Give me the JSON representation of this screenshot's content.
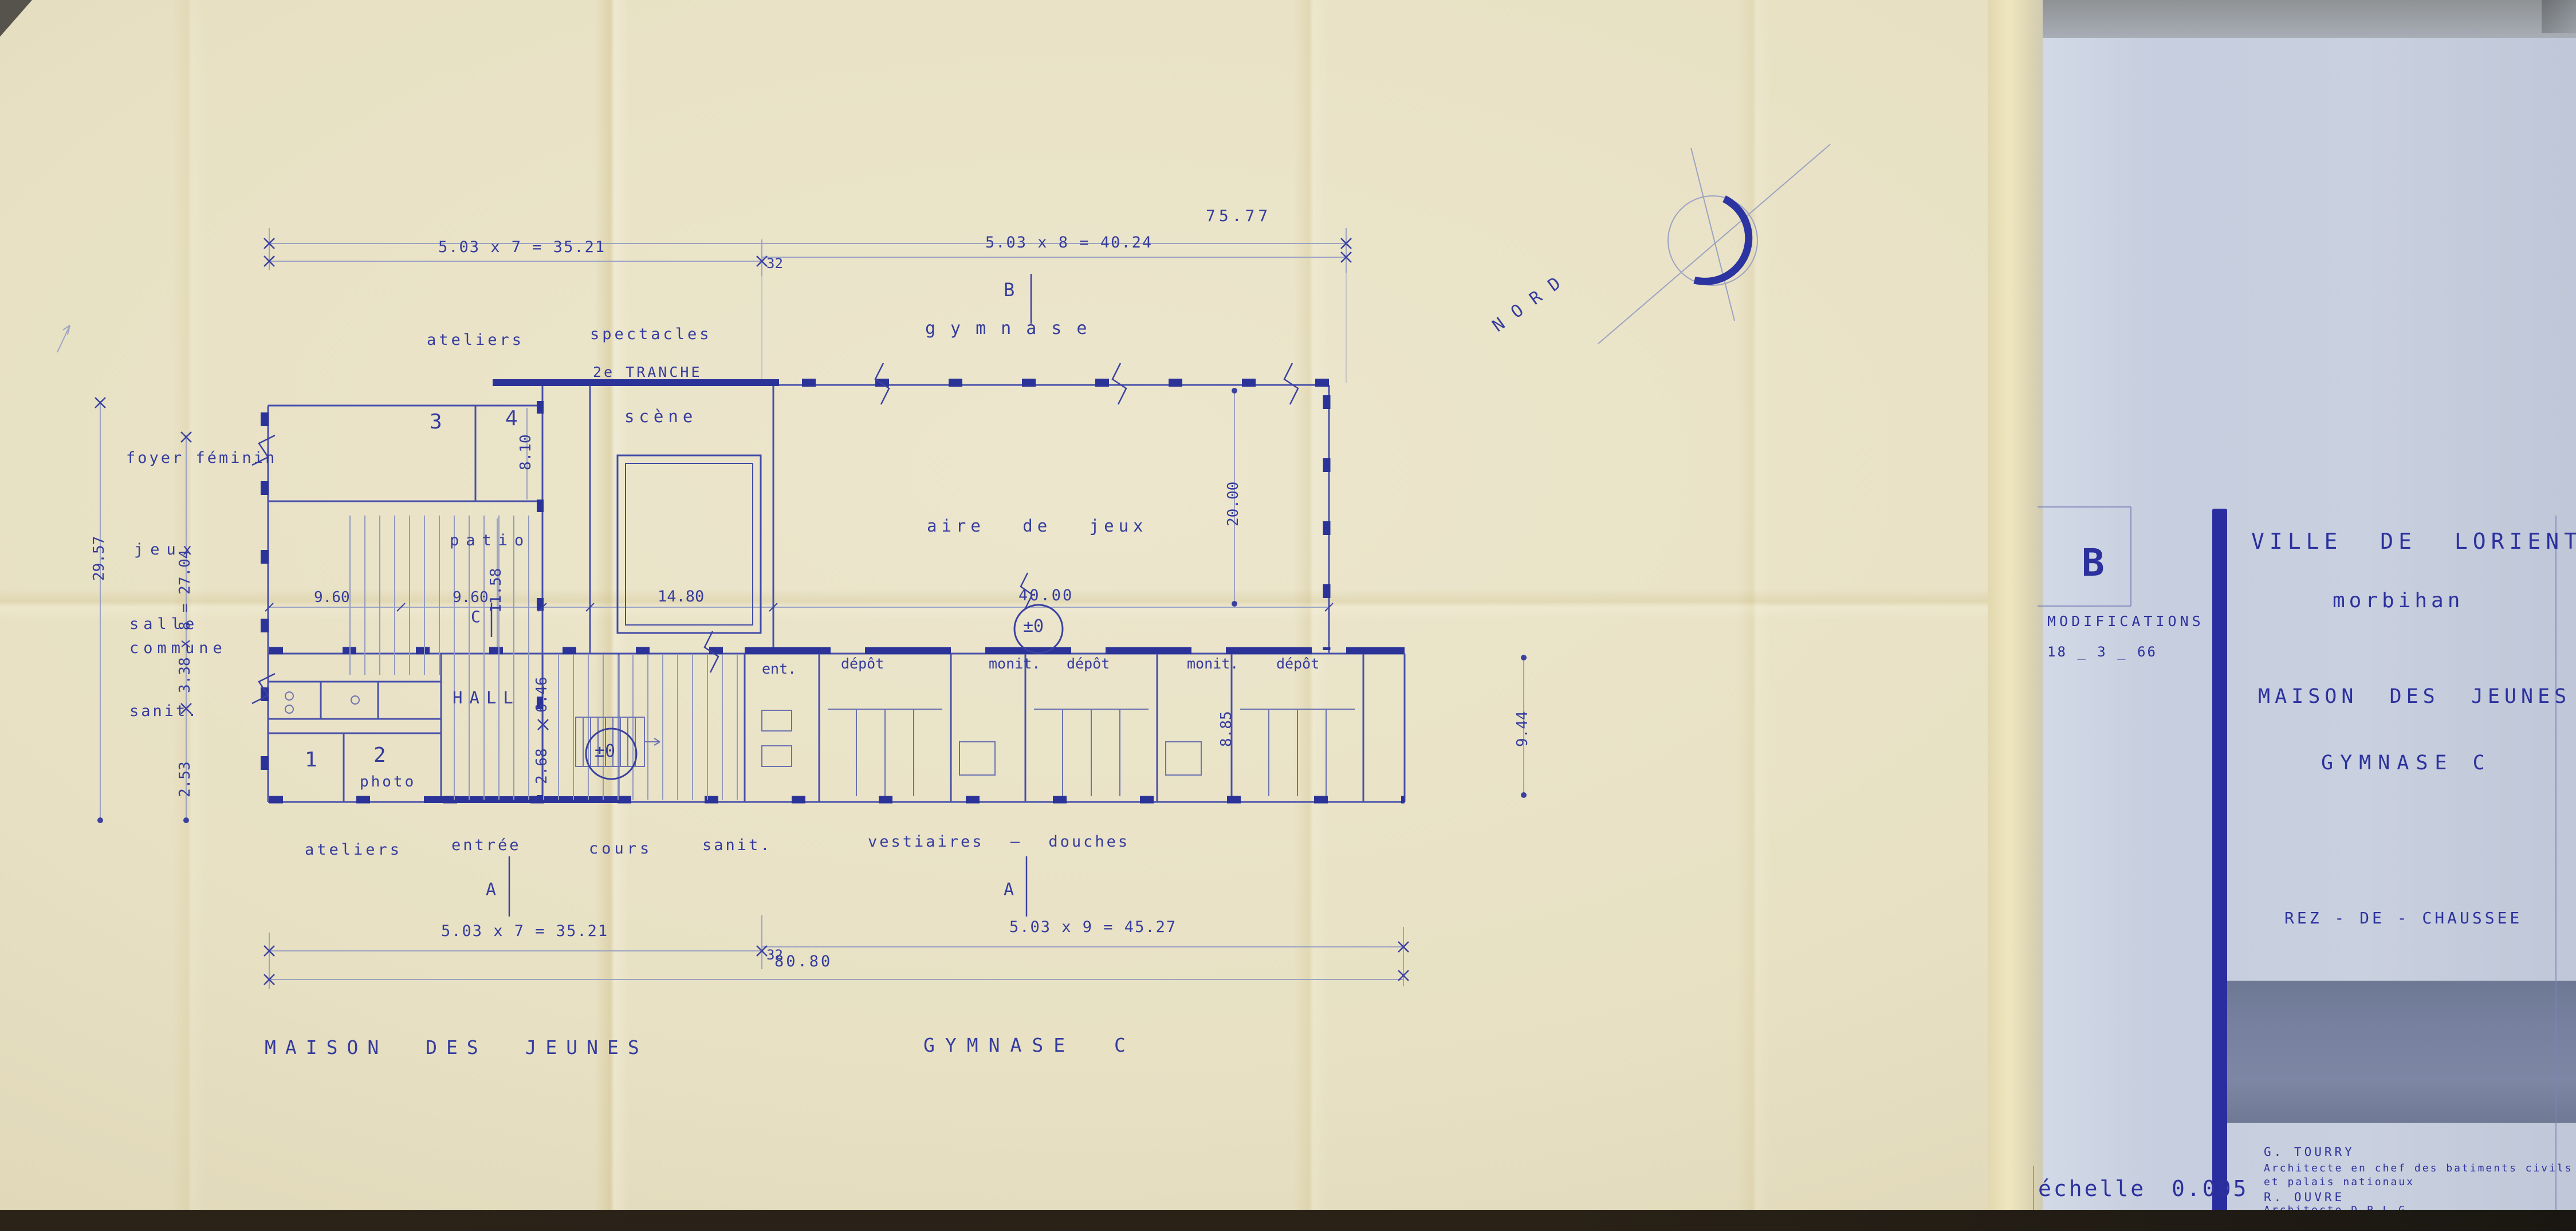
{
  "colors": {
    "paper": "#e8e1c4",
    "panel": "#c6cedf",
    "slate_band": "#77819f",
    "ink": "#353c9e",
    "ink_dark": "#2c319e",
    "pencil": "#9ca3c3",
    "edge": "#2b2318"
  },
  "title_block": {
    "revision_letter": "B",
    "modifications_label": "MODIFICATIONS",
    "modification_date": "18 _ 3 _ 66",
    "city": "VILLE DE LORIENT",
    "department": "morbihan",
    "project": "MAISON DES JEUNES",
    "building": "GYMNASE C",
    "level": "REZ - DE - CHAUSSEE",
    "scale_label": "échelle 0.005",
    "architect1_name": "G. TOURRY",
    "architect1_title_line1": "Architecte en chef des batiments civils",
    "architect1_title_line2": "et palais nationaux",
    "architect2_name": "R. OUVRE",
    "architect2_title": "Architecte D.P.L.G."
  },
  "plan": {
    "north": "NORD",
    "dims": {
      "top_overall": "75.77",
      "top_left": "5.03 x 7 = 35.21",
      "joint": "32",
      "top_right": "5.03 x 8 = 40.24",
      "bottom_left": "5.03 x 7 = 35.21",
      "bottom_right": "5.03 x 9 = 45.27",
      "bottom_overall": "80.80",
      "left_overall": "29.57",
      "left_grid": "3.38 x 8 = 27.04",
      "left_end": "2.53",
      "right_height": "9.44",
      "gym_length": "40.00",
      "gym_width": "20.00",
      "stage_width": "14.80",
      "patio_w1": "9.60",
      "patio_w2": "9.60",
      "patio_depth": "11.58",
      "room4_depth": "8.10",
      "hall_depth": "6.46",
      "hall_lower": "2.68",
      "vest_depth": "8.85"
    },
    "zones": {
      "ateliers_top": "ateliers",
      "spectacles": "spectacles",
      "tranche": "2e TRANCHE",
      "gymnase": "gymnase",
      "foyer": "foyer féminin",
      "jeux": "jeux",
      "salle1": "salle",
      "salle2": "commune",
      "sanit_left": "sanit.",
      "scene": "scène",
      "patio": "patio",
      "aire": "aire de jeux",
      "hall": "HALL",
      "photo": "photo",
      "ent": "ent.",
      "depot": "dépôt",
      "monit": "monit.",
      "room1": "1",
      "room2": "2",
      "room3": "3",
      "room4": "4"
    },
    "bottom_labels": {
      "ateliers": "ateliers",
      "entree": "entrée",
      "cours": "cours",
      "sanit": "sanit.",
      "vestiaires": "vestiaires — douches"
    },
    "markers": {
      "a": "A",
      "b": "B",
      "c": "C",
      "level": "±0"
    },
    "footer": {
      "left": "MAISON DES JEUNES",
      "right": "GYMNASE C"
    }
  }
}
